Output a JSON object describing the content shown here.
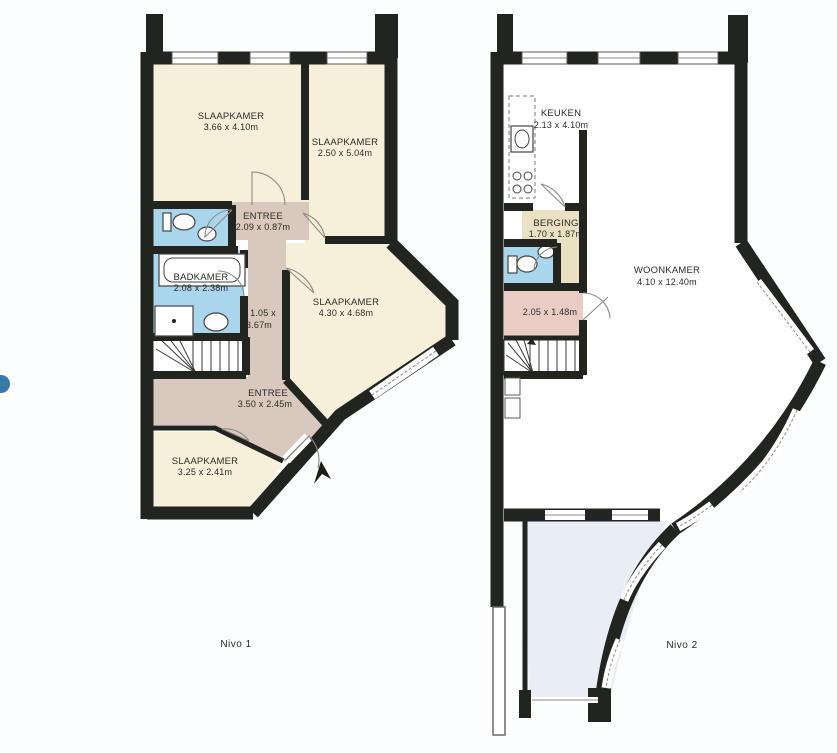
{
  "document": {
    "type": "floor-plan-scan",
    "caption_left": "Nivo 1",
    "caption_right": "Nivo 2"
  },
  "colors": {
    "wall": "#22241f",
    "text": "#2b2b27",
    "room_cream": "#f6f0da",
    "room_taupe": "#d8c8bd",
    "room_pink": "#e9cdc5",
    "room_blue": "#a9d6ec",
    "room_tan": "#eae1c4",
    "terrace_blue": "#e9edf4",
    "white": "#ffffff",
    "glass_line": "#8a8a86",
    "accent_dot": "#3a78aa"
  },
  "plans": [
    {
      "caption": "Nivo 1",
      "rooms": [
        {
          "name": "SLAAPKAMER",
          "dims": "3.66 x 4.10m"
        },
        {
          "name": "SLAAPKAMER",
          "dims": "2.50 x 5.04m"
        },
        {
          "name": "ENTREE",
          "dims": "2.09 x 0.87m"
        },
        {
          "name": "BADKAMER",
          "dims": "2.08 x 2.38m"
        },
        {
          "name": "",
          "dims": "1.05 x",
          "dims2": "3.67m"
        },
        {
          "name": "SLAAPKAMER",
          "dims": "4.30 x 4.68m"
        },
        {
          "name": "ENTREE",
          "dims": "3.50 x 2.45m"
        },
        {
          "name": "SLAAPKAMER",
          "dims": "3.25 x 2.41m"
        }
      ]
    },
    {
      "caption": "Nivo 2",
      "rooms": [
        {
          "name": "KEUKEN",
          "dims": "2.13 x 4.10m"
        },
        {
          "name": "BERGING",
          "dims": "1.70 x 1.87m"
        },
        {
          "name": "",
          "dims": "2.05 x 1.48m"
        },
        {
          "name": "WOONKAMER",
          "dims": "4.10 x 12.40m"
        }
      ]
    }
  ]
}
